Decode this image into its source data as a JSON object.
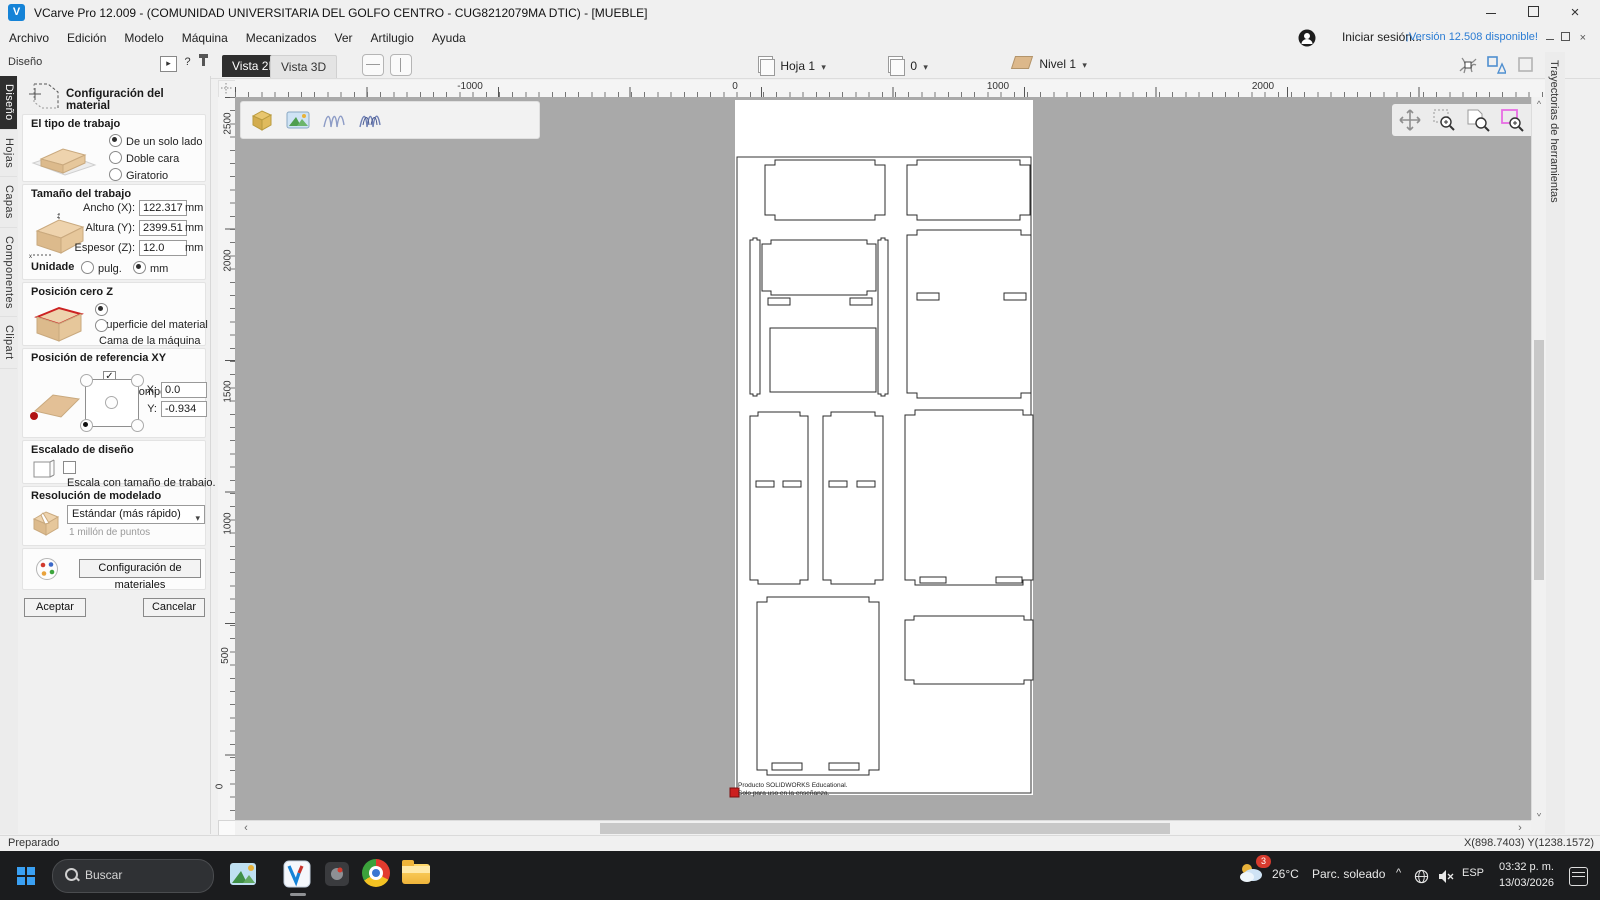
{
  "icons": {
    "caret": "▾",
    "close": "×",
    "chev_left": "‹",
    "chev_right": "›",
    "chev_up": "^",
    "help": "?",
    "collapse": "▸"
  },
  "window": {
    "title": "VCarve Pro 12.009 - (COMUNIDAD UNIVERSITARIA DEL GOLFO CENTRO - CUG8212079MA DTIC) - [MUEBLE]",
    "signin": "Iniciar sesión...",
    "version_link": "¡Versión 12.508 disponible!"
  },
  "menus": [
    "Archivo",
    "Edición",
    "Modelo",
    "Máquina",
    "Mecanizados",
    "Ver",
    "Artilugio",
    "Ayuda"
  ],
  "side_tabs": [
    "Diseño",
    "Hojas",
    "Capas",
    "Componentes",
    "Clipart"
  ],
  "right_tab": "Trayectorias de herramientas",
  "view_tabs": {
    "v2d": "Vista 2D",
    "v3d": "Vista 3D"
  },
  "toolbar": {
    "sheet": "Hoja 1",
    "zero": "0",
    "level": "Nivel 1"
  },
  "panel": {
    "dock_title": "Diseño",
    "title": "Configuración del material",
    "job_type": {
      "label": "El tipo de trabajo",
      "options": [
        "De un solo lado",
        "Doble cara",
        "Giratorio"
      ],
      "selected": "De un solo lado"
    },
    "job_size": {
      "label": "Tamaño del trabajo",
      "fields": [
        {
          "label": "Ancho (X):",
          "value": "122.317",
          "unit": "mm"
        },
        {
          "label": "Altura (Y):",
          "value": "2399.51",
          "unit": "mm"
        },
        {
          "label": "Espesor (Z):",
          "value": "12.0",
          "unit": "mm"
        }
      ],
      "units_label": "Unidade",
      "units_options": [
        "pulg.",
        "mm"
      ],
      "units_selected": "mm"
    },
    "z_zero": {
      "label": "Posición cero Z",
      "options": [
        "Superficie del material",
        "Cama de la máquina"
      ],
      "selected": "Superficie del material"
    },
    "xy_datum": {
      "label": "Posición de referencia XY",
      "offset_label": "Usar compensación",
      "x_label": "X:",
      "x_value": "0.0",
      "y_label": "Y:",
      "y_value": "-0.934"
    },
    "scaling": {
      "label": "Escalado de diseño",
      "checkbox": "Escala con tamaño de trabajo."
    },
    "resolution": {
      "label": "Resolución de modelado",
      "value": "Estándar (más rápido)",
      "note": "1 millón de puntos"
    },
    "materials_button": "Configuración de materiales",
    "ok": "Aceptar",
    "cancel": "Cancelar"
  },
  "rulers": {
    "top": [
      {
        "label": "-1000",
        "x": 470
      },
      {
        "label": "0",
        "x": 735
      },
      {
        "label": "1000",
        "x": 998
      },
      {
        "label": "2000",
        "x": 1263
      }
    ],
    "left": [
      {
        "label": "2500",
        "y": 130
      },
      {
        "label": "2000",
        "y": 267
      },
      {
        "label": "1500",
        "y": 398
      },
      {
        "label": "1000",
        "y": 530
      },
      {
        "label": "500",
        "y": 662
      },
      {
        "label": "0",
        "y": 793
      }
    ]
  },
  "drawing": {
    "note_line1": "Producto SOLIDWORKS Educational.",
    "note_line2": "Solo para uso en la enseñanza."
  },
  "statusbar": {
    "left": "Preparado",
    "coords": "X(898.7403) Y(1238.1572)"
  },
  "taskbar": {
    "search": "Buscar",
    "weather_temp": "26°C",
    "weather_cond": "Parc. soleado",
    "weather_badge": "3",
    "lang": "ESP",
    "time": "03:32 p. m.",
    "date": "13/03/2026"
  },
  "colors": {
    "accent_blue": "#2b7cd3",
    "canvas_gray": "#a9a9a9",
    "tab_dark": "#2e2e2e",
    "taskbar": "#1b1c1e",
    "origin_red": "#cc1f1f",
    "zoom_magenta": "#e86ee4"
  }
}
